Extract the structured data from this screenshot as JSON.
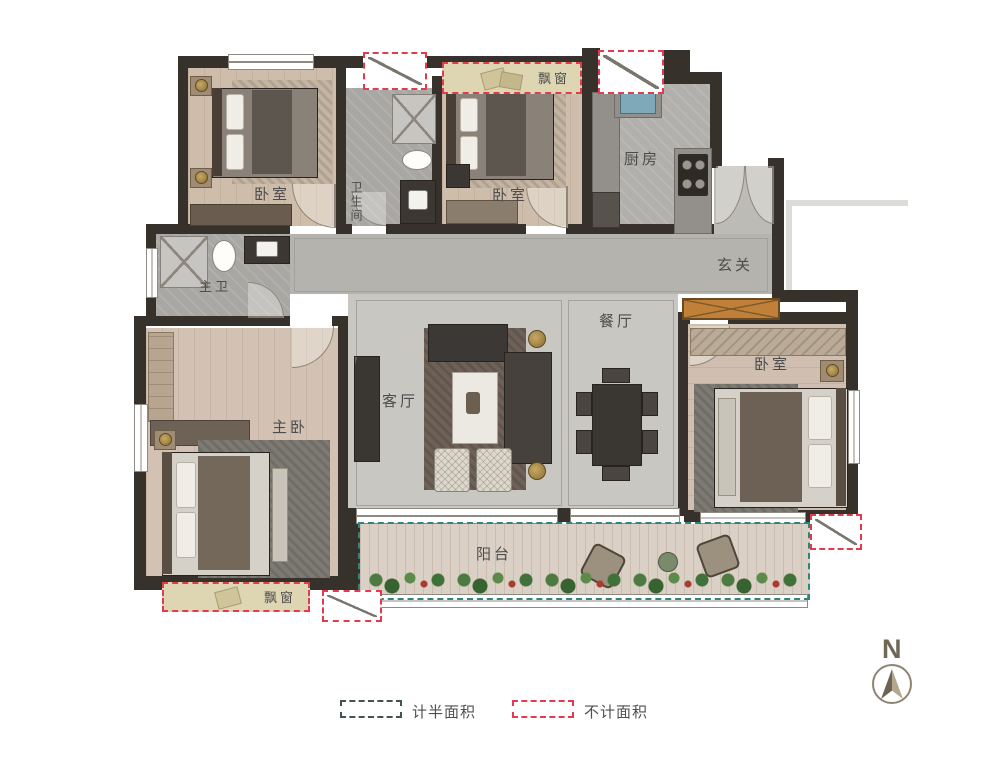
{
  "rooms": {
    "bedroom_top_left": {
      "label": "卧室"
    },
    "bathroom_top": {
      "label": "卫生间"
    },
    "bedroom_top_middle": {
      "label": "卧室"
    },
    "kitchen": {
      "label": "厨房"
    },
    "foyer": {
      "label": "玄关"
    },
    "master_bathroom": {
      "label": "主卫"
    },
    "master_bedroom": {
      "label": "主卧"
    },
    "living_room": {
      "label": "客厅"
    },
    "dining_room": {
      "label": "餐厅"
    },
    "bedroom_right": {
      "label": "卧室"
    },
    "balcony": {
      "label": "阳台"
    }
  },
  "annotations": {
    "bay_window_top": {
      "label": "飘窗"
    },
    "bay_window_bottom": {
      "label": "飘窗"
    }
  },
  "legend": {
    "half_area": {
      "label": "计半面积",
      "color": "#3d564f"
    },
    "excluded_area": {
      "label": "不计面积",
      "color": "#e23b50"
    }
  },
  "compass": {
    "label": "N"
  },
  "colors": {
    "wall": "#36312b",
    "wood_floor": "#cfbdac",
    "tile_floor": "#c9c7c1",
    "balcony_dash": "#2f8578",
    "excluded_dash": "#e23b50",
    "bay_fill": "#ded6b3",
    "wardrobe_orange": "#c08038"
  }
}
